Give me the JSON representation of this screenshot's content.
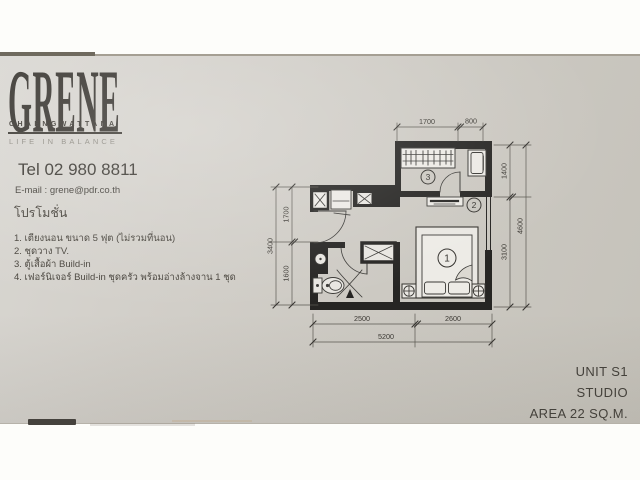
{
  "colors": {
    "paper": "#cfccc6",
    "ink": "#3b3832",
    "wall": "#262523",
    "tagline_gray": "#8d8a82"
  },
  "logo": {
    "brand": "GRENE",
    "location": "CHAENGWATTANA",
    "tagline": "LIFE IN BALANCE"
  },
  "contact": {
    "tel": "Tel 02 980 8811",
    "email": "E-mail : grene@pdr.co.th"
  },
  "promotion": {
    "heading": "โปรโมชั่น",
    "items": [
      "1.  เตียงนอน ขนาด 5 ฟุต (ไม่รวมที่นอน)",
      "2.  ชุดวาง TV.",
      "3.  ตู้เสื้อผ้า Build-in",
      "4.  เฟอร์นิเจอร์ Build-in ชุดครัว พร้อมอ่างล้างจาน 1 ชุด"
    ]
  },
  "floorplan": {
    "dims": {
      "top_wardrobe": "1700",
      "top_entry": "800",
      "right_upper": "1400",
      "right_lower": "3100",
      "right_total": "4600",
      "left_upper": "1700",
      "left_lower": "1600",
      "left_total": "3400",
      "bottom_left": "2500",
      "bottom_right": "2600",
      "bottom_total": "5200"
    },
    "markers": {
      "bed": "1",
      "tv": "2",
      "wardrobe": "3"
    }
  },
  "unit": {
    "name": "UNIT S1",
    "type": "STUDIO",
    "area": "AREA 22 SQ.M."
  }
}
